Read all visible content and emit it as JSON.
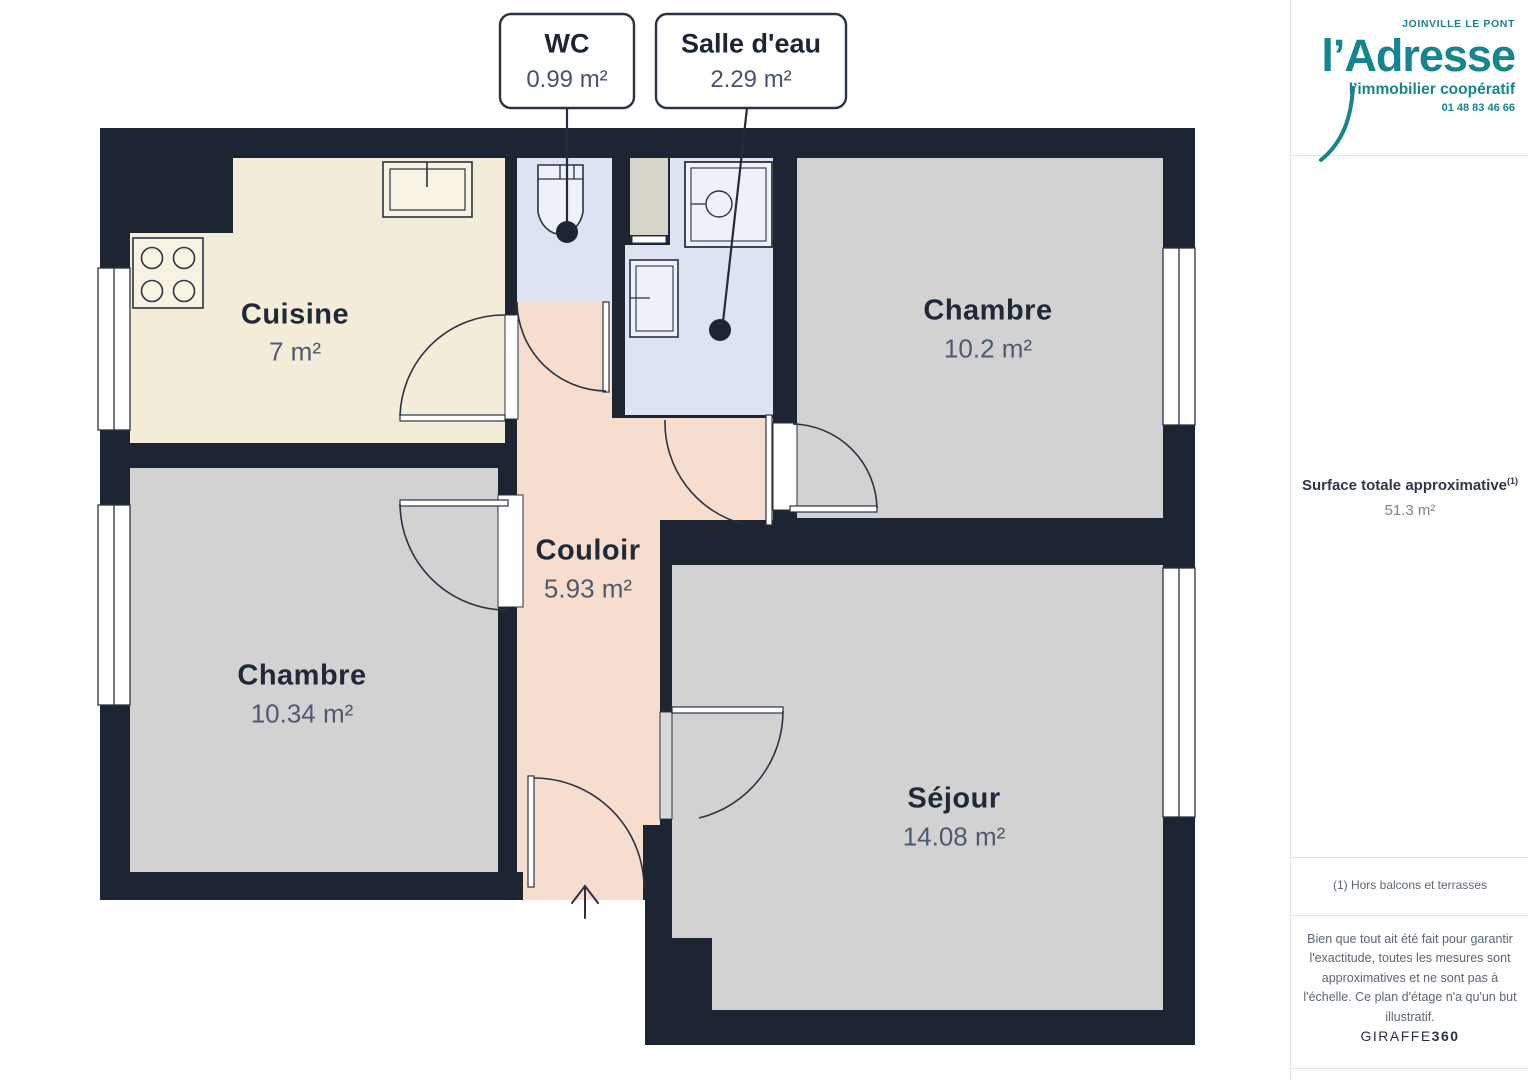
{
  "plan": {
    "callouts": [
      {
        "name": "WC",
        "area": "0.99 m²"
      },
      {
        "name": "Salle d'eau",
        "area": "2.29 m²"
      }
    ],
    "rooms": [
      {
        "name": "Cuisine",
        "area": "7 m²"
      },
      {
        "name": "Chambre",
        "area": "10.2 m²"
      },
      {
        "name": "Couloir",
        "area": "5.93 m²"
      },
      {
        "name": "Chambre",
        "area": "10.34 m²"
      },
      {
        "name": "Séjour",
        "area": "14.08 m²"
      }
    ],
    "total_rooms_labeled": 7
  },
  "sidebar": {
    "brand": {
      "location": "JOINVILLE LE PONT",
      "name": "l’Adresse",
      "tagline": "l’immobilier coopératif",
      "phone": "01 48 83 46 66"
    },
    "surface_title": "Surface totale approximative",
    "surface_footnote_ref": "(1)",
    "surface_value": "51.3 m²",
    "footnote": "(1) Hors balcons et terrasses",
    "disclaimer": "Bien que tout ait été fait pour garantir l'exactitude, toutes les mesures sont approximatives et ne sont pas à l'échelle. Ce plan d'étage n'a qu'un but illustratif.",
    "watermark_brand": "GIRAFFE",
    "watermark_suffix": "360"
  },
  "colors": {
    "wall": "#1d2532",
    "kitchen_floor": "#f2ecd9",
    "bedroom_floor": "#d2d2d2",
    "corridor_floor": "#f7ddcd",
    "bathroom_floor": "#dde3f0",
    "shaft": "#d7d4ca",
    "brand_teal": "#16858e",
    "label_dark": "#1f2937",
    "label_gray": "#4e5a70"
  }
}
